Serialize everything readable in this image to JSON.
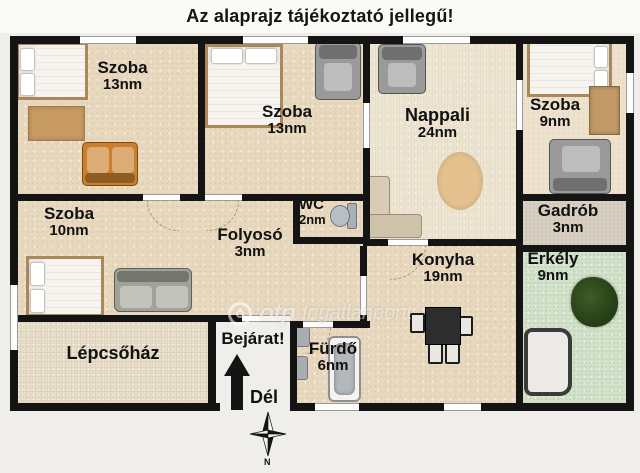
{
  "title": "Az alaprajz tájékoztató jellegű!",
  "rooms": [
    {
      "name": "Szoba",
      "area": "13nm"
    },
    {
      "name": "Szoba",
      "area": "13nm"
    },
    {
      "name": "Nappali",
      "area": "24nm"
    },
    {
      "name": "Szoba",
      "area": "9nm"
    },
    {
      "name": "Szoba",
      "area": "10nm"
    },
    {
      "name": "Folyosó",
      "area": "3nm"
    },
    {
      "name": "WC",
      "area": "2nm"
    },
    {
      "name": "Konyha",
      "area": "19nm"
    },
    {
      "name": "Gadrób",
      "area": "3nm"
    },
    {
      "name": "Erkély",
      "area": "9nm"
    },
    {
      "name": "Lépcsőház",
      "area": ""
    },
    {
      "name": "Fürdő",
      "area": "6nm"
    }
  ],
  "entrance": {
    "label": "Bejárat!",
    "direction_label": "Dél"
  },
  "compass": {
    "north_label": "N"
  },
  "watermark": {
    "brand": "otp",
    "suffix": "Ingatlanpont"
  },
  "icons": {
    "furniture": [
      "double-bed-icon",
      "armchair-icon",
      "sofa-icon",
      "corner-sofa-icon",
      "rug-icon",
      "oval-rug-icon",
      "wardrobe-icon",
      "toilet-icon",
      "dining-table-icon",
      "chair-icon",
      "bathtub-icon",
      "sink-icon",
      "plant-icon",
      "bench-icon",
      "arrow-up-icon",
      "compass-rose-icon"
    ]
  },
  "colors": {
    "wall": "#141414",
    "floor_beige": "#e8d8be",
    "floor_cream": "#ece4d0",
    "floor_green": "#d2e2ca",
    "floor_gray": "#d7d0c2",
    "background": "#efeeea"
  }
}
